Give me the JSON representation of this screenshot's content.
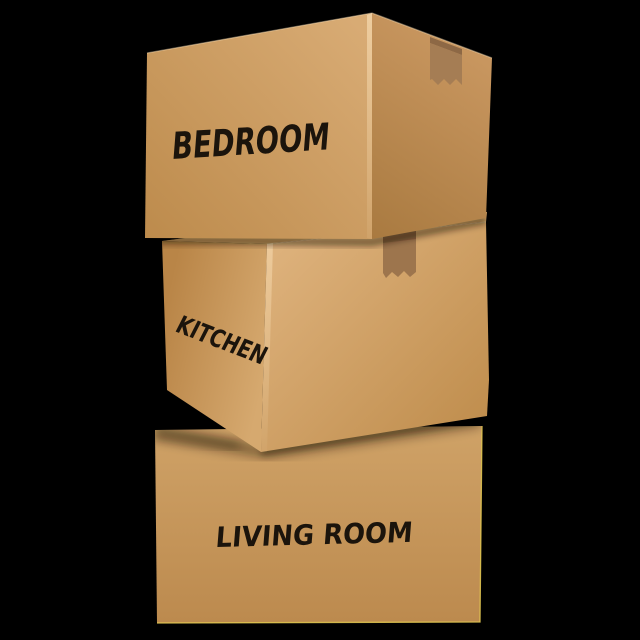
{
  "scene": {
    "background": "#000000",
    "text_color": "#1b140c",
    "shadow_color": "#140b04",
    "highlight_color": "#ffe8c2",
    "boxes": [
      {
        "id": "bedroom",
        "label": "BEDROOM",
        "position": "top",
        "tape": "packing-tape",
        "colors": {
          "left_face_light": "#d8ab74",
          "left_face_dark": "#bc8a4b",
          "right_face_light": "#c99760",
          "right_face_dark": "#a97a40",
          "tape": "#a57d54",
          "tape_shadow": "#8d6845"
        }
      },
      {
        "id": "kitchen",
        "label": "KITCHEN",
        "position": "middle",
        "tape": "packing-tape",
        "colors": {
          "left_face_light": "#d6a96f",
          "left_face_dark": "#b98547",
          "right_face_light": "#ddb17b",
          "right_face_dark": "#c08e4e",
          "top_face": "#cfa165",
          "tape": "#9d754d",
          "tape_shadow": "#8a6240"
        }
      },
      {
        "id": "living_room",
        "label": "LIVING ROOM",
        "position": "bottom",
        "colors": {
          "face_light": "#cfa267",
          "face_dark": "#bc8a4e",
          "edge_highlight": "#e6cb52"
        }
      }
    ]
  }
}
